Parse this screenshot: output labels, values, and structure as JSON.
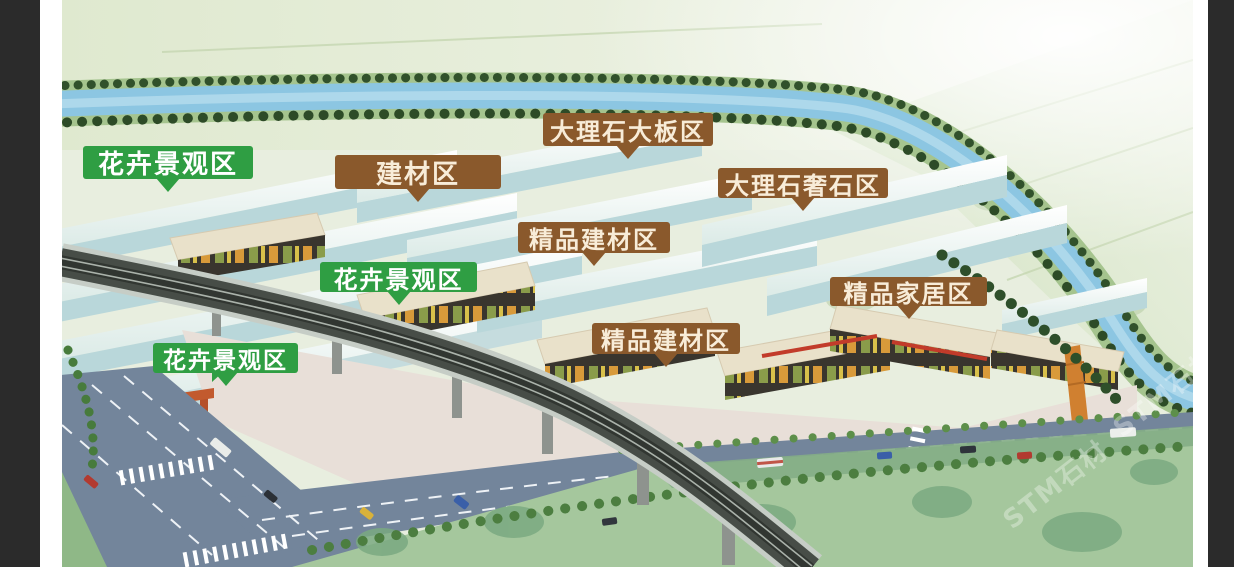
{
  "labels": [
    {
      "text": "花卉景观区",
      "type": "green"
    },
    {
      "text": "建材区",
      "type": "brown"
    },
    {
      "text": "大理石大板区",
      "type": "brown"
    },
    {
      "text": "大理石奢石区",
      "type": "brown"
    },
    {
      "text": "精品建材区",
      "type": "brown"
    },
    {
      "text": "花卉景观区",
      "type": "green"
    },
    {
      "text": "精品家居区",
      "type": "brown"
    },
    {
      "text": "精品建材区",
      "type": "brown"
    },
    {
      "text": "花卉景观区",
      "type": "green"
    }
  ],
  "zones": [
    "花卉景观区",
    "建材区",
    "大理石大板区",
    "大理石奢石区",
    "精品建材区",
    "精品家居区"
  ],
  "watermark": {
    "text": "STM石材"
  },
  "colors": {
    "label_green": "#2f9e43",
    "label_brown": "#8a592c",
    "label_text_green": "#ffffff",
    "label_text_brown": "#f8ecd8",
    "river": "#8cc6e2",
    "frame_dark": "#2b2b2b",
    "field_green": "#dfe9cf",
    "road": "#73859b",
    "lawn": "#a5c79d"
  }
}
